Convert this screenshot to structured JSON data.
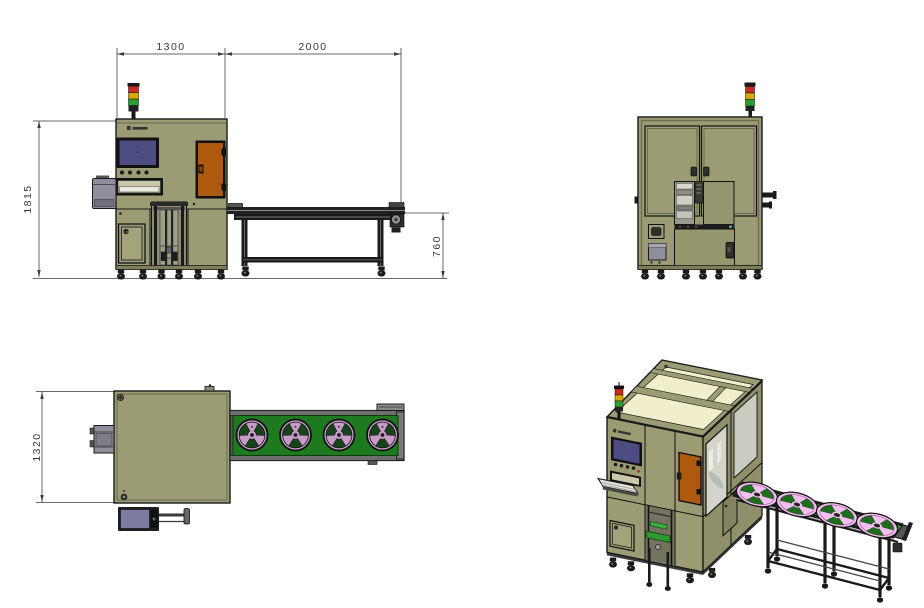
{
  "document": {
    "type": "cad-multiview-machine-drawing",
    "background": "#ffffff",
    "description": "Four-view engineering drawing of an inspection machine cabinet with outfeed reel conveyor"
  },
  "dimensions": {
    "cabinet_width": "1300",
    "conveyor_length": "2000",
    "machine_height": "1815",
    "conveyor_height": "760",
    "machine_depth": "1320"
  },
  "views": {
    "front": "front-elevation-view",
    "rear": "rear-elevation-view",
    "top": "top-plan-view",
    "isometric": "isometric-view"
  },
  "icons": {
    "signal_tower": "stack-light-red-yellow-green",
    "reel": "pink-carrier-tape-reel",
    "logo": "small-illegible-brand-mark"
  },
  "colors": {
    "cabinet_body": "#9C9C74",
    "roof_panel": "#F1EECB",
    "access_door_orange": "#AD5A0E",
    "hmi_screen_blue": "#4D4D84",
    "conveyor_belt_green": "#1E7A1F",
    "reel_pink_top_view": "#C79CC9",
    "reel_pink_iso_view": "#F2BFEE",
    "tower_red": "#CC2A1E",
    "tower_yellow": "#D9A800",
    "tower_green": "#2AA02A",
    "side_box_gray": "#8E8E9C",
    "frame_black": "#1A1A1A",
    "dimension_lines": "#3A3A3A"
  }
}
